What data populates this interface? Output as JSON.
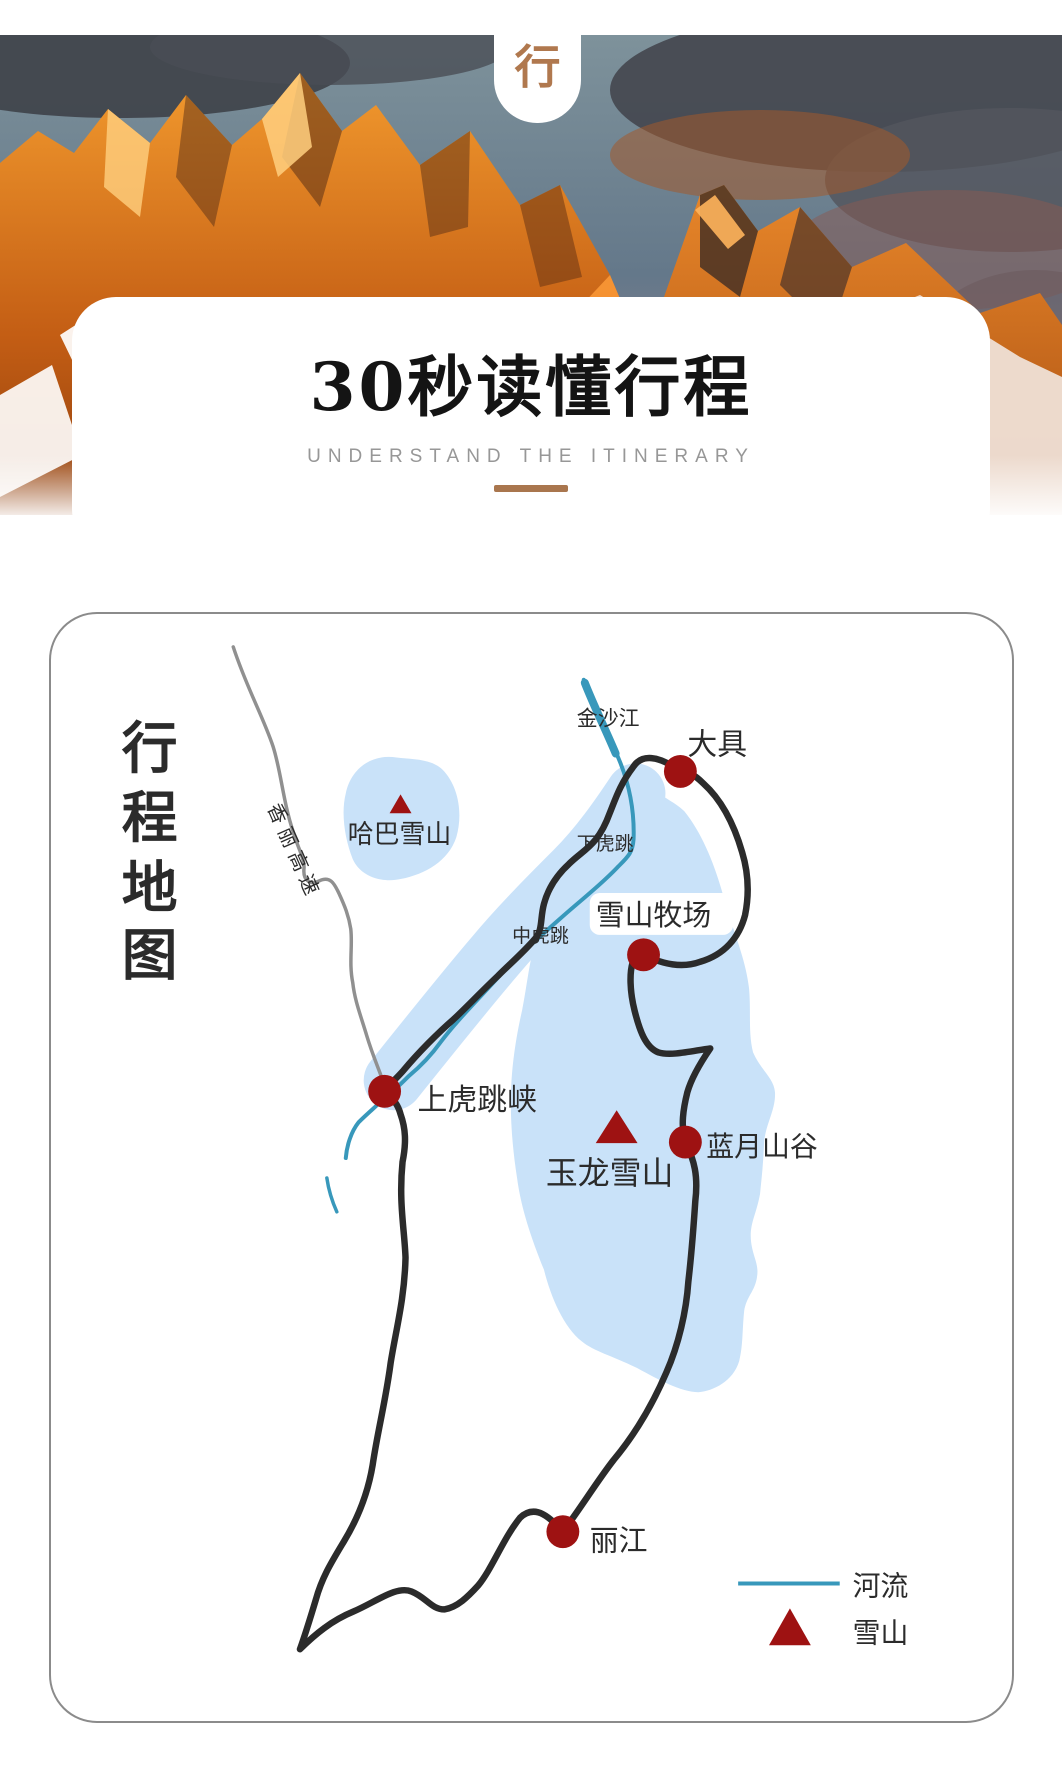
{
  "badge": {
    "label": "行",
    "color": "#b0784e"
  },
  "title_card": {
    "title": "30秒读懂行程",
    "subtitle": "UNDERSTAND THE ITINERARY",
    "accent_color": "#a9764e"
  },
  "map_card": {
    "vertical_title": {
      "text": "行程地图",
      "chars": [
        "行",
        "程",
        "地",
        "图"
      ],
      "color": "#5b84ad"
    },
    "labels": {
      "jinshajiang": "金沙江",
      "daju": "大具",
      "haba_snow_mountain": "哈巴雪山",
      "lower_tiger_leap": "下虎跳",
      "middle_tiger_leap": "中虎跳",
      "snow_mountain_pasture": "雪山牧场",
      "upper_tiger_leaping_gorge": "上虎跳峡",
      "jade_dragon_snow_mountain": "玉龙雪山",
      "blue_moon_valley": "蓝月山谷",
      "lijiang": "丽江",
      "xiangli_expressway": "香丽高速"
    },
    "legend": {
      "river_label": "河流",
      "snow_mountain_label": "雪山",
      "river_color": "#3898bb",
      "marker_color": "#9e1212"
    },
    "colors": {
      "route": "#2b2b2b",
      "region_fill": "#c9e2f9",
      "road": "#909090",
      "stop_dot": "#9e1212",
      "border": "#8b8b8b"
    }
  }
}
